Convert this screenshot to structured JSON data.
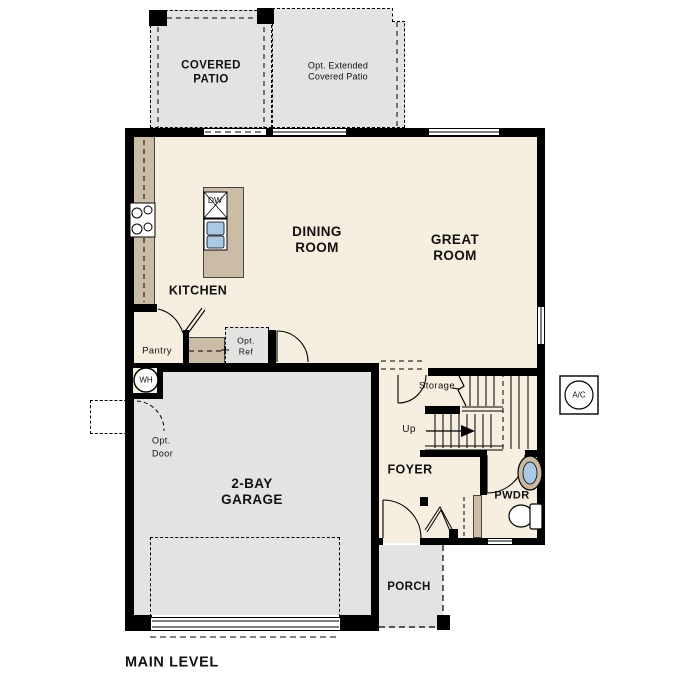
{
  "title": {
    "level_label": "MAIN LEVEL"
  },
  "colors": {
    "wall": "#000000",
    "interior_floor": "#f6eede",
    "concrete_floor": "#e3e3e1",
    "counter_tan": "#cbbca6",
    "sink_blue": "#a9c9e7"
  },
  "rooms": {
    "covered_patio": {
      "line1": "COVERED",
      "line2": "PATIO"
    },
    "ext_patio": {
      "line1": "Opt. Extended",
      "line2": "Covered Patio"
    },
    "dining": {
      "line1": "DINING",
      "line2": "ROOM"
    },
    "great": {
      "line1": "GREAT",
      "line2": "ROOM"
    },
    "kitchen": {
      "label": "KITCHEN"
    },
    "pantry": {
      "label": "Pantry"
    },
    "foyer": {
      "label": "FOYER"
    },
    "powder": {
      "label": "PWDR"
    },
    "garage": {
      "line1": "2-BAY",
      "line2": "GARAGE"
    },
    "porch": {
      "label": "PORCH"
    },
    "storage": {
      "label": "Storage"
    }
  },
  "annotations": {
    "up": "Up",
    "opt_ref": {
      "line1": "Opt.",
      "line2": "Ref"
    },
    "opt_door": {
      "line1": "Opt.",
      "line2": "Door"
    }
  },
  "fixtures": {
    "dishwasher": "DW",
    "water_heater": "WH",
    "ac_unit": "A/C"
  }
}
